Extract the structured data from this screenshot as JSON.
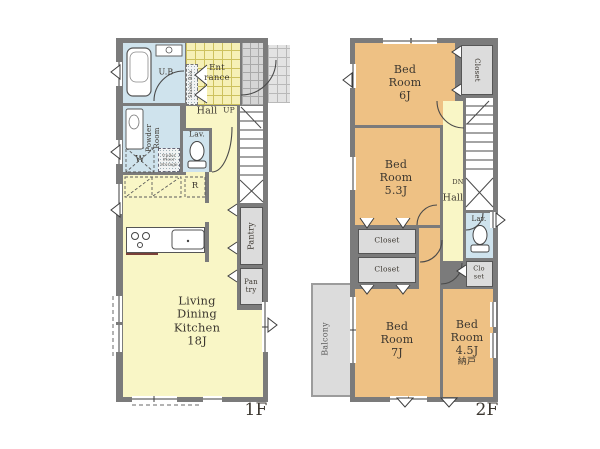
{
  "palette": {
    "wall": "#7b7b7b",
    "living_yellow": "#f9f6c6",
    "wet_area_blue": "#cfe3ed",
    "bedroom_orange": "#eec184",
    "storage_gray": "#dcdcdc",
    "balcony_gray": "#dcdcdc"
  },
  "floor1": {
    "floor_label": "1F",
    "living_dining_kitchen": "Living\nDining\nKitchen\n18J",
    "hall": "Hall",
    "up": "UP",
    "unit_bath": "U.B",
    "powder_room": "Powder\nRoom",
    "lavatory": "Lav.",
    "entrance": "Ent\nrance",
    "shoes_box": "Shoes Box",
    "pantry": "Pantry",
    "pantry_small": "Pan\ntry",
    "washer": "W",
    "refrigerator": "R",
    "underfloor_storage": "Under\nFloor\nStorage"
  },
  "floor2": {
    "floor_label": "2F",
    "bedroom_6": "Bed\nRoom\n6J",
    "bedroom_53": "Bed\nRoom\n5.3J",
    "bedroom_7": "Bed\nRoom\n7J",
    "bedroom_45": "Bed\nRoom\n4.5J",
    "bedroom_45_sub": "納戸",
    "closet_top": "Closet",
    "closet_mid_upper": "Closet",
    "closet_mid_lower": "Closet",
    "closet_side": "Clo\nset",
    "hall": "Hall",
    "down": "DN",
    "lavatory": "Lav.",
    "balcony": "Balcony"
  }
}
